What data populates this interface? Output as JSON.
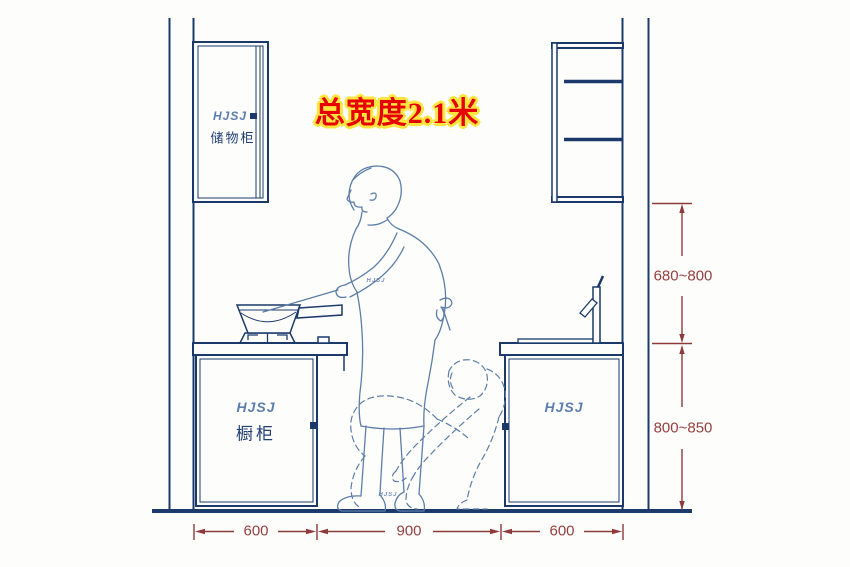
{
  "title": {
    "text": "总宽度2.1米"
  },
  "cabinets": {
    "left_upper": {
      "logo": "HJSJ",
      "label": "储物柜"
    },
    "left_base": {
      "logo": "HJSJ",
      "label": "橱柜"
    },
    "right_base": {
      "logo": "HJSJ"
    }
  },
  "figure": {
    "waist_logo": "HJSJ",
    "shoe_logo": "HJSJ"
  },
  "dimensions": {
    "upper_cabinet_to_counter": "680~800",
    "counter_height": "800~850",
    "bottom_widths": [
      "600",
      "900",
      "600"
    ]
  },
  "colors": {
    "drawing_line": "#1b3a6b",
    "figure_line": "#5d7ea8",
    "dimension": "#8e3a3a",
    "title_red": "#e60000",
    "title_outline": "#ffe53e"
  }
}
